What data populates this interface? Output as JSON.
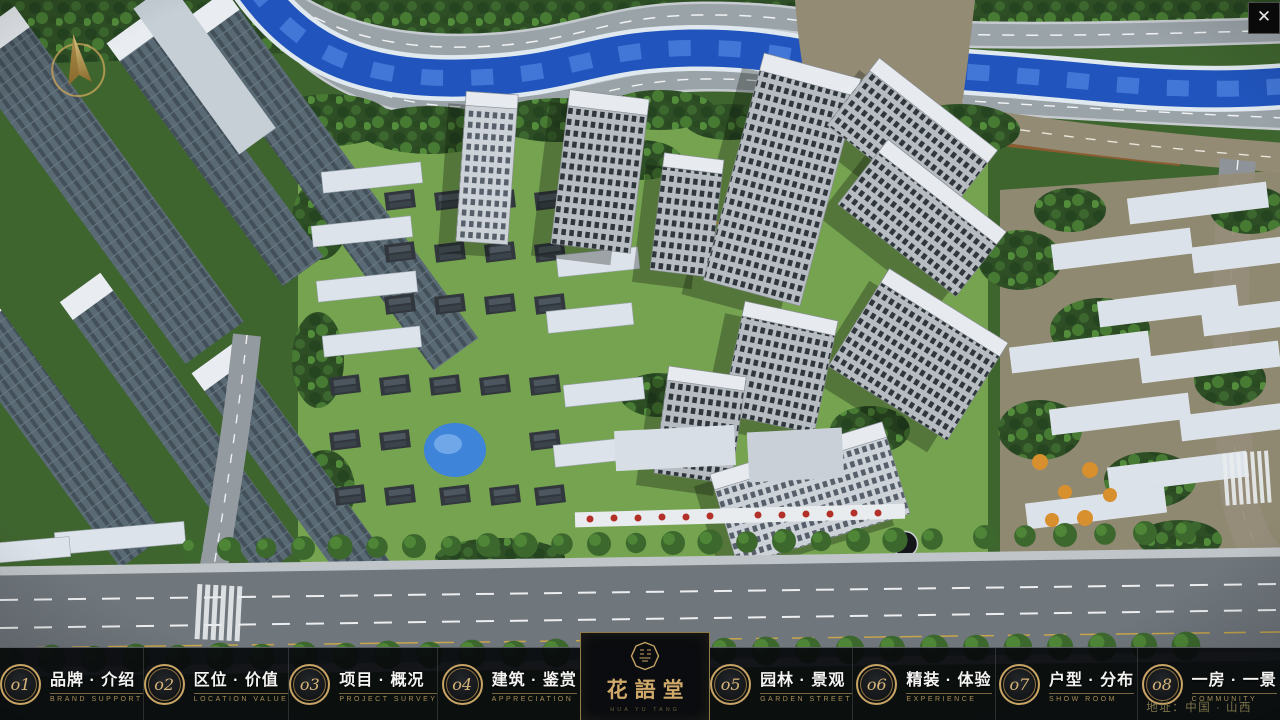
{
  "window": {
    "close_label": "✕"
  },
  "nav": {
    "items": [
      {
        "num": "o1",
        "cn": "品牌 · 介绍",
        "en": "BRAND SUPPORT"
      },
      {
        "num": "o2",
        "cn": "区位 · 价值",
        "en": "LOCATION VALUE"
      },
      {
        "num": "o3",
        "cn": "项目 · 概况",
        "en": "PROJECT SURVEY"
      },
      {
        "num": "o4",
        "cn": "建筑 · 鉴赏",
        "en": "APPRECIATION"
      },
      {
        "num": "o5",
        "cn": "园林 · 景观",
        "en": "GARDEN STREET"
      },
      {
        "num": "o6",
        "cn": "精装 · 体验",
        "en": "EXPERIENCE"
      },
      {
        "num": "o7",
        "cn": "户型 · 分布",
        "en": "SHOW ROOM"
      },
      {
        "num": "o8",
        "cn": "一房 · 一景",
        "en": "COMMUNITY"
      }
    ]
  },
  "logo": {
    "title": "花語堂",
    "subtitle": "HUA YU TANG"
  },
  "footer": {
    "address": "地址：中国 · 山西"
  },
  "colors": {
    "gold": "#c8a465",
    "bar_bg": "#0a0c0f",
    "river": "#2155bd",
    "road": "#9aa3a8"
  }
}
